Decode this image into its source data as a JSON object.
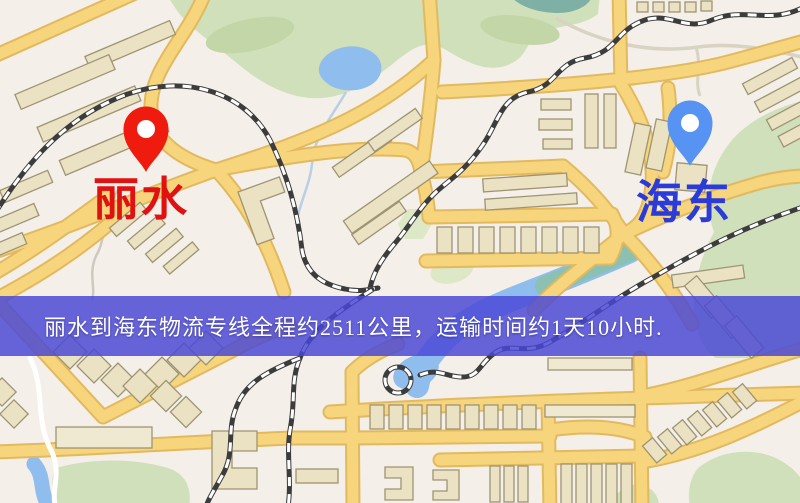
{
  "map": {
    "origin": {
      "name": "丽水",
      "pin_color": "#ee1b0e",
      "label_color": "#e01111"
    },
    "destination": {
      "name": "海东",
      "pin_color": "#5693f2",
      "label_color": "#2b3bd8"
    },
    "banner": {
      "text": "丽水到海东物流专线全程约2511公里，运输时间约1天10小时.",
      "background": "#4a47d5",
      "text_color": "#ffffff"
    },
    "legend_colors": {
      "road": "#f7d57c",
      "road_casing": "#e2b95f",
      "park": "#cfe0ba",
      "water": "#8fbdee",
      "railway": "#3c3c3c",
      "building": "#eae2c2",
      "background": "#f4efe8"
    }
  }
}
